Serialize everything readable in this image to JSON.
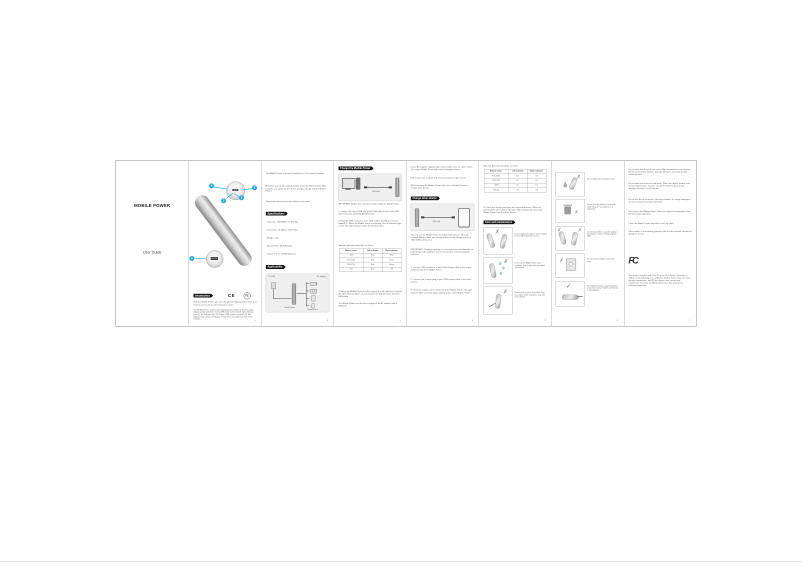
{
  "cover": {
    "title": "MOBILE POWER",
    "subtitle": "User Guide"
  },
  "page1": {
    "callouts": [
      "4",
      "3",
      "1",
      "2",
      "5"
    ],
    "section_intro": "Introduction",
    "ce_mark": "CE",
    "fc_mark": "FC",
    "p1": "With the Mobile Power, you can charge your digital product when you have no access to an external power source.",
    "p2": "The Mobile Power contains the following ports shown on the first page: output control switch (1), micro-USB input connector (2), right indicator light (3), left indicator light (4), A type USB output connector (5). This product may contain small parts. Keep them out of the reach of small children.",
    "page_no": "1"
  },
  "page2": {
    "p1": "The Mobile Power is meant for partial use / occasional charging.",
    "p2": "Read this user guide carefully before using the Mobile Power. Also, read the user guide for the device that you charge with the Mobile Power.",
    "p3": "Stay power wherever you go whatever you need.",
    "section_specs": "Specifications",
    "specs": [
      "- Capacity : 2200mAh/3.7V (8.14W)",
      "- Dimension: 25.4(dia) x 105mm(L)",
      "- Weight : 75g",
      "- Input: DC5V / 800mA (max)",
      "- Output: DC 5V / 1000mA (max)"
    ],
    "section_applicability": "Applicability",
    "diagram": {
      "label_top_left": "PC USB",
      "label_top_right": "AC adapters",
      "label_bottom_left": "Mobile Power",
      "label_bottom_right": "Digital devices"
    },
    "page_no": "2"
  },
  "page3": {
    "section_charge": "Charge the Mobile Power",
    "diagram_label": "USB cable",
    "important": "IMPORTANT: Before first use please fully charge the Mobile Power.",
    "steps": [
      "1. Connect the micro-USB end of the USB cable to the micro-USB input connector (2) of the Mobile Power.",
      "2. Plug the USB connector of the USB cable into USB port of your laptop/PC. Whilst the Mobile Power is charging, the left indicator light is red. The right indicator shows the battery status:"
    ],
    "table_caption": "Indicator behavior should be as follow:",
    "table": {
      "headers": [
        "Battery status",
        "Left indicator",
        "Right indicator"
      ],
      "rows": [
        [
          "<25%",
          "Red",
          "Red"
        ],
        [
          "25%-50%",
          "Red",
          "Green"
        ],
        [
          "50%-75%",
          "Red",
          "Green"
        ],
        [
          "Full",
          "Red",
          "Off"
        ]
      ]
    },
    "step3": "3. When the Mobile Power is fully charged, the left indicator is off and the right indicator light is on. Disconnect the Mobile Power from the USB cable.",
    "note": "The Mobile Power can also be charged via an AC adapter with a USB port.",
    "page_no": "3"
  },
  "page4": {
    "p1": "If your AC adapter supports big current output, you can open switch (1) to open Mobile Power big-current charging function.",
    "p2": "Full charge time is about 3 to 5 hours based on input current.",
    "p3": "While charging the Mobile Power, you can use Mobile Power to charge other device.",
    "section": "Charge other device",
    "diagram_label": "USB cable",
    "p4": "You can use the Mobile Power to charge other device. The fully charged Mobile Power has enough power to fully charge at least a 1800 mAh battery once.",
    "important": "IMPORTANT: Charging capacity is a calculated one and depends on battery age and conditions and on temperature and consumption behavior.",
    "steps": [
      "1. Connect USB connector of your USB charge cable to the output connector (5) of the Mobile Power.",
      "2. Connect the charger plug of your USB charge cable to the other device.",
      "3. Open the output control switch (1) of the Mobile Power. The right indicator light is on and shows battery status of the Mobile Power."
    ],
    "page_no": "4"
  },
  "page5": {
    "table_caption": "Indicator behavior should be as follow:",
    "table": {
      "headers": [
        "Battery status",
        "Left indicator",
        "Right indicator"
      ],
      "rows": [
        [
          "75%-100%",
          "On",
          "On"
        ],
        [
          "50%-75%",
          "On",
          "On"
        ],
        [
          "<25%",
          "On",
          "On"
        ],
        [
          "Full out",
          "Off",
          "Off"
        ]
      ]
    },
    "step4": "4. Check the charge level from the connected device. When the battery of the other device has been fully charged, disconnect the Mobile Power from the other device.",
    "section": "Care and maintenance",
    "cards": [
      "Do not charge the product in direct sunlight or near high temperature sources.",
      "Do not use the Mobile Power in wet conditions; keep it away from rain, liquids and moisture.",
      "Do not crush or pierce the product. Keep the product and its small parts away from small children."
    ],
    "page_no": "5"
  },
  "page6": {
    "cards": [
      "Do not dispose of the product in a fire.",
      "Do not throw the product in household waste. Recycle it according to local regulations.",
      "Do not disassemble or open the product. Do not place it close to strong magnetic fields.",
      "Do not wash the product or put it into water.",
      "For long-term storage, charge the product at least once every 3 months and keep it in a cool, dry place."
    ],
    "page_no": "6"
  },
  "page7": {
    "paragraphs": [
      "Do not store the device in hot areas. High temperatures can shorten the life of electronic devices, damage batteries, and warp or melt certain plastics.",
      "Do not store the device in cold areas. When the device returns to its normal temperature, moisture can form inside the device and damage electronic circuit boards.",
      "Do not use harsh chemicals, cleaning solvents, or strong detergents to clean and prevent proper operation.",
      "Do not paint the Mobile Power. Paint can clog the moving parts and prevent proper operation.",
      "Clean the Mobile Power only with a soft, dry cloth.",
      "If the product is not working properly, take it to the nearest authorized facility for service."
    ],
    "fcc_logo": "FC",
    "fcc_statement": "This device complies with Part 15 of the FCC Rules. Operation is subject to the following two conditions: (1) this device may not cause harmful interference, and (2) this device must accept any interference received, including interference that may cause undesired operation.",
    "page_no": "7"
  }
}
